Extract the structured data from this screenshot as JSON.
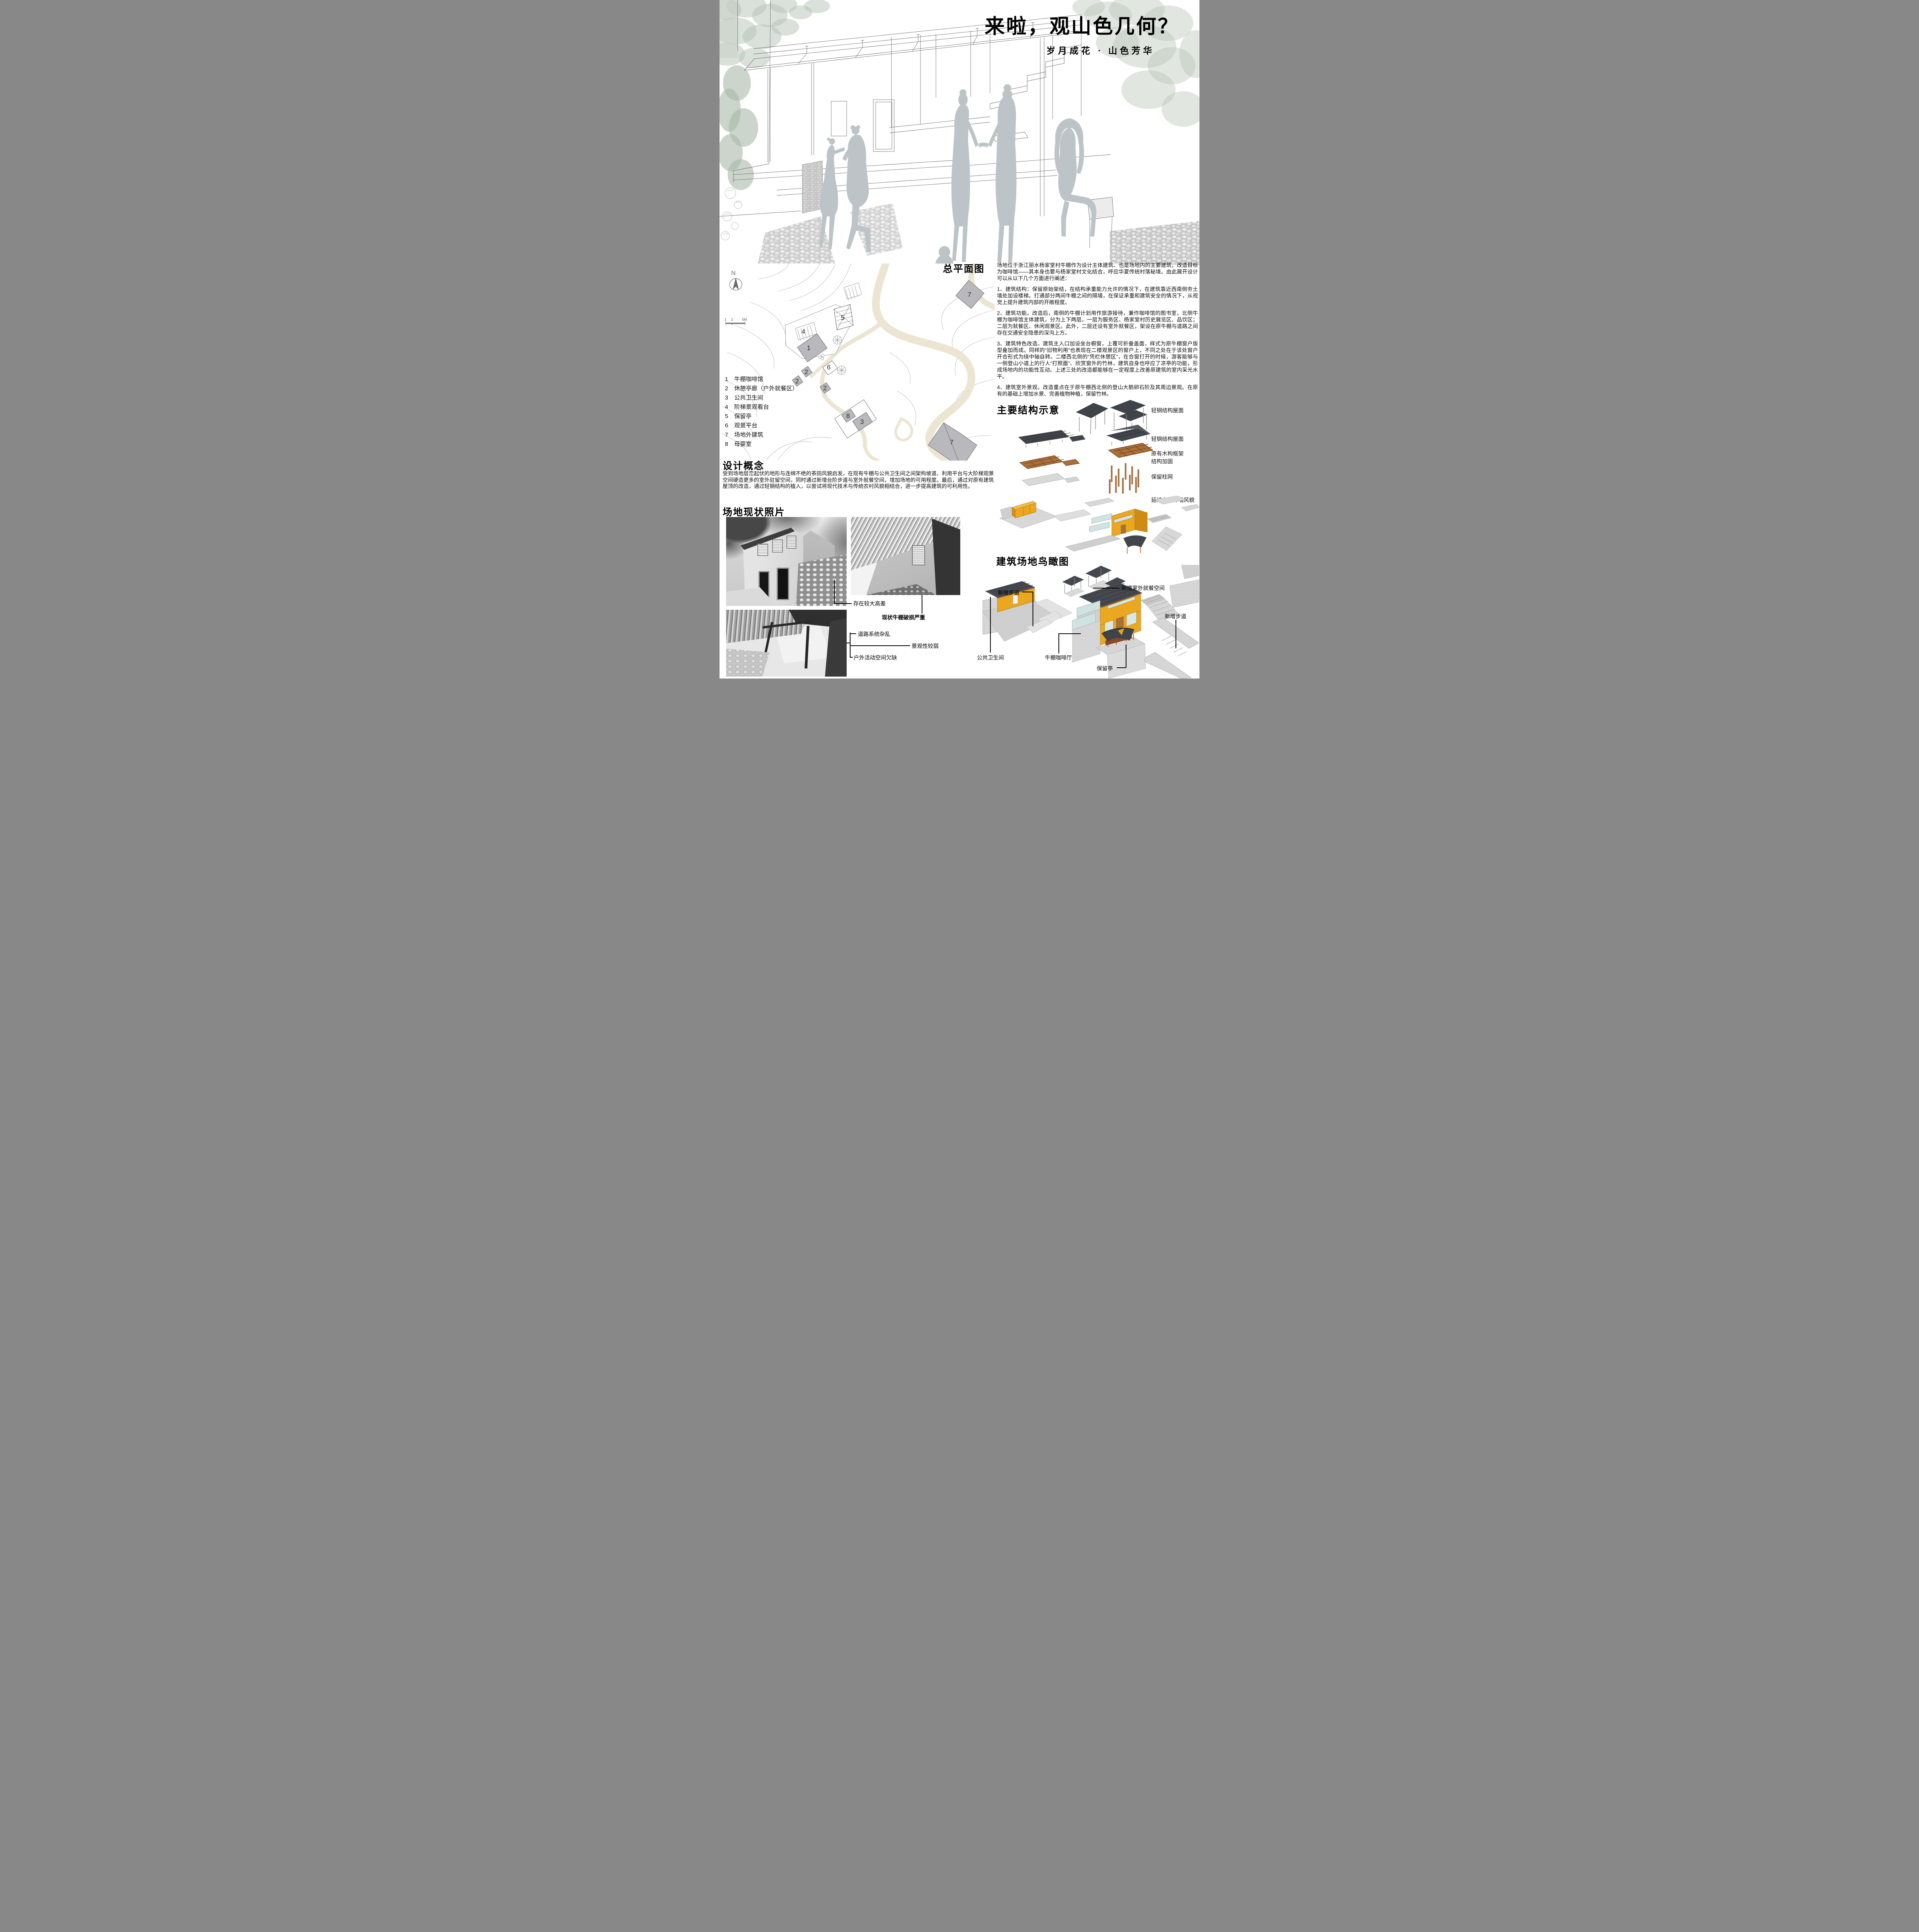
{
  "title": "来啦，观山色几何？",
  "subtitle": "岁月成花 · 山色芳华",
  "site_plan": {
    "heading": "总平面图",
    "north_label": "N",
    "scale_ticks": [
      "1",
      "2",
      "5M"
    ],
    "legend": [
      {
        "num": "1",
        "label": "牛棚咖啡馆"
      },
      {
        "num": "2",
        "label": "休憩亭廊（户外就餐区）"
      },
      {
        "num": "3",
        "label": "公共卫生间"
      },
      {
        "num": "4",
        "label": "阶梯景观看台"
      },
      {
        "num": "5",
        "label": "保留亭"
      },
      {
        "num": "6",
        "label": "观景平台"
      },
      {
        "num": "7",
        "label": "场地外建筑"
      },
      {
        "num": "8",
        "label": "母婴室"
      }
    ],
    "markers": [
      "1",
      "2",
      "2",
      "2",
      "3",
      "4",
      "5",
      "6",
      "7",
      "7",
      "8"
    ]
  },
  "overview": {
    "paragraphs": [
      "场地位于浙江丽水杨家堂村牛棚作为设计主体建筑、也是场地内的主要建筑，改造目标为咖啡馆——其本身也要与杨家堂村文化结合，呼应华夏传统村落秘境。由此展开设计可以从以下几个方面进行阐述：",
      "1、建筑结构：保留原始架结，在结构承重能力允许的情况下，在建筑靠近西南侧夯土墙处加设楼梯。打通部分两间牛棚之间的隔墙，在保证承重和建筑安全的情况下，从视觉上提升建筑内部的开敞程度。",
      "2、建筑功能。改造后，南侧的牛棚计划用作旅游接待，兼作咖啡馆的图书室，北侧牛棚为咖啡馆主体建筑，分为上下两层，一层为服务区、杨家堂村历史展览区、品饮区；二层为就餐区、休闲观景区。此外，二层还设有室外就餐区，架设在原牛棚与道路之间存在交通安全隐患的深沟上方。",
      "3、建筑特色改造。建筑主入口加设坐台橱窗，上覆可折叠盖面，样式为原牛棚窗户版型叠加而成。同样的“旧物利用”也表现在二楼观景区的窗户上，不同之处在于该处窗户开合形式为绕中轴自转。二楼西北侧的“凭栏休憩区”，在合窗打开的时候，游客能够与一侧登山小道上的行人“打照面”、欣赏窗外的竹林，建筑自身也呼应了凉亭的功能，形成场地内的功能性互动。上述三处的改造都能够在一定程度上改善原建筑的室内采光水平。",
      "4、建筑室外景观。改造重点在于原牛棚西北侧的登山大鹅卵石阶及其周边景观。在原有的基础上增加水景、完善植物种植，保留竹林。"
    ]
  },
  "structure": {
    "heading": "主要结构示意",
    "labels": [
      "轻钢结构屋面",
      "轻钢结构屋面",
      "原有木构框架",
      "结构加固",
      "保留柱网",
      "延续夯土外墙风貌"
    ]
  },
  "concept": {
    "heading": "设计概念",
    "body": "受到场地层峦起伏的地形与连绵不绝的茶田风貌启发，在现有牛棚与公共卫生间之间架构坡道、利用平台与大阶梯观景空间硬造更多的室外驻留空间，同时通过新增台阶步道与室外就餐空间，增加场地的可用程度。最后，通过对原有建筑屋顶的改造，通过轻钢结构的植入，以尝试将现代技术与传统农村风貌相结合，进一步提高建筑的可利用性。"
  },
  "photos": {
    "heading": "场地现状照片",
    "annotations": [
      "存在较大高差",
      "现状牛棚破损严重",
      "道路系统杂乱",
      "景观性较弱",
      "户外活动空间欠缺"
    ]
  },
  "aerial": {
    "heading": "建筑场地鸟瞰图",
    "labels": [
      "新增步道",
      "新增室外就餐空间",
      "新增步道",
      "公共卫生间",
      "牛棚咖啡厅",
      "保留亭"
    ]
  },
  "colors": {
    "accent_yellow": "#e9a71f",
    "roof_dark": "#45494f",
    "wood_brown": "#a5713c",
    "road_beige": "#ece5d1",
    "silhouette_gray": "#bdc4c7",
    "tree_green": "#b5c1b5"
  }
}
